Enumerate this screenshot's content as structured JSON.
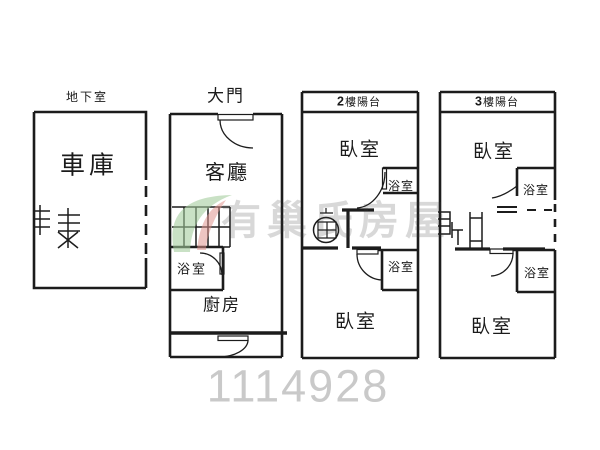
{
  "canvas": {
    "width": 600,
    "height": 450
  },
  "colors": {
    "background": "#ffffff",
    "line": "#1c1c1c",
    "watermark_leaf_green": "#a3cc9b",
    "watermark_leaf_red": "#e0938d",
    "watermark_text_gray": "#cbcbcb",
    "listing_number_gray": "#c9c9c9"
  },
  "labels": {
    "basement": "地下室",
    "garage": "車庫",
    "entrance": "大門",
    "living_room": "客廳",
    "bathroom": "浴室",
    "kitchen": "廚房",
    "bedroom": "臥室",
    "balcony_2f_num": "2",
    "balcony_3f_num": "3",
    "balcony_suffix": "樓陽台"
  },
  "watermark": {
    "brand_text": "有巢氏房屋",
    "listing_number": "1114928"
  }
}
